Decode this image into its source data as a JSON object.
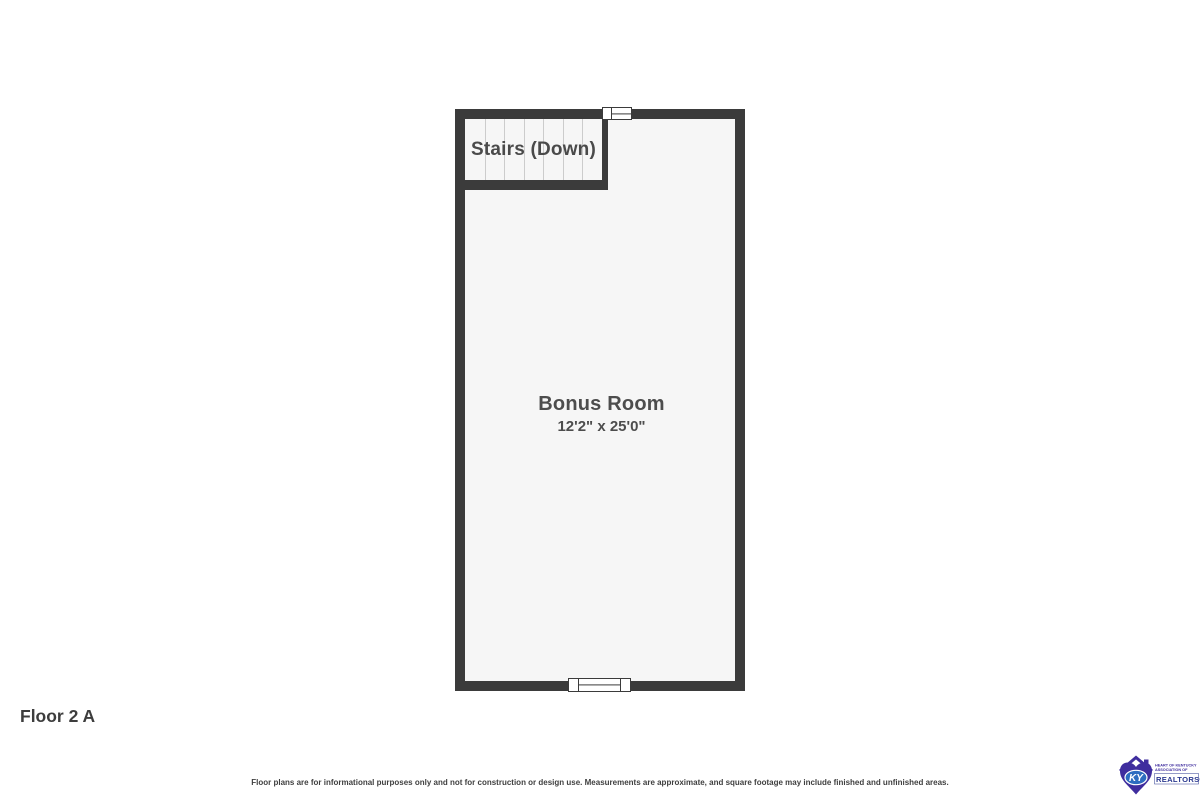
{
  "floor_plan": {
    "floor_label": "Floor 2 A",
    "stairs": {
      "label": "Stairs (Down)",
      "tread_line_count": 6
    },
    "room": {
      "name": "Bonus Room",
      "dimensions": "12'2\" x 25'0\""
    },
    "colors": {
      "wall": "#3b3b3b",
      "floor": "#f6f6f6",
      "tread_line": "#cccccc",
      "text": "#4a4a4a"
    }
  },
  "footer": {
    "disclaimer": "Floor plans are for informational purposes only and not for construction or design use. Measurements are approximate, and square footage may include finished and unfinished areas."
  },
  "logo": {
    "monogram": "KY",
    "org_line1": "HEART OF KENTUCKY",
    "org_line2": "ASSOCIATION OF",
    "org_line3": "REALTORS®",
    "colors": {
      "purple": "#3f2d9e",
      "blue": "#2d6cc0",
      "realtor_blue": "#2b3990"
    }
  }
}
